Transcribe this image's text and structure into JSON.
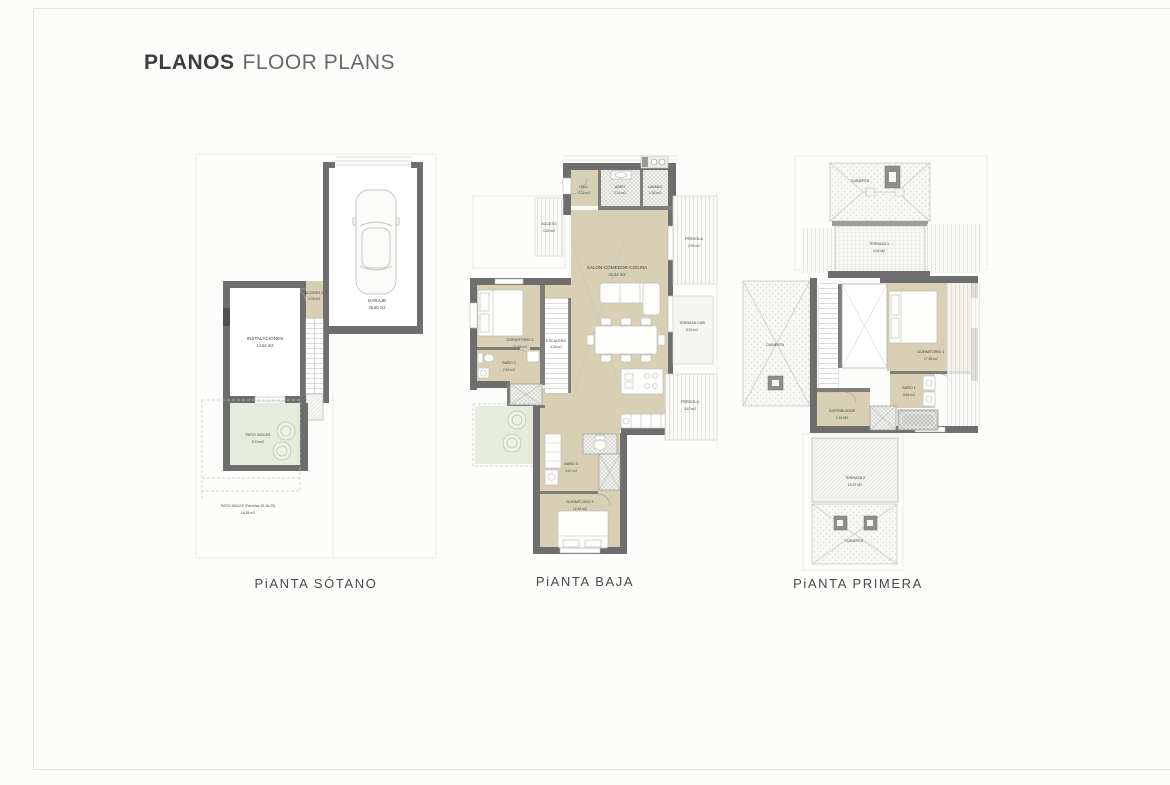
{
  "header": {
    "title_bold": "PLANOS",
    "title_light": "FLOOR PLANS"
  },
  "captions": {
    "sotano": "PiANTA SÓTANO",
    "baja": "PiANTA BAJA",
    "primera": "PiANTA PRIMERA"
  },
  "sotano": {
    "garaje": {
      "name": "GARAJE",
      "area": "26.50 m2"
    },
    "acceso2": {
      "name": "ACCESO 2",
      "area": "4.95 m2"
    },
    "instalaciones": {
      "name": "INSTALACIONES",
      "area": "14.64 m2"
    },
    "patio": {
      "name": "PATIO INGLES",
      "area": "8.10 m2"
    },
    "patio_parcelas": {
      "name": "PATIO INGLES (Parcelas 15-16-29)",
      "area": "16.38 m2"
    }
  },
  "baja": {
    "hall": {
      "name": "HALL",
      "area": "2.02 m2"
    },
    "aseo": {
      "name": "ASEO",
      "area": "2.24 m2"
    },
    "lavado": {
      "name": "LAVADO",
      "area": "1.92 m2"
    },
    "acceso": {
      "name": "ACCESO",
      "area": "3.20 m2"
    },
    "pergola1": {
      "name": "PÉRGOLA",
      "area": "2.90 m2"
    },
    "salon": {
      "name": "SALON-COMEDOR-COCINA",
      "area": "41.44 m2"
    },
    "escalera": {
      "name": "ESCALERA",
      "area": "4.38 m2"
    },
    "dormitorio2": {
      "name": "DORMITORIO 2",
      "area": "11.44 m2"
    },
    "bano2": {
      "name": "BAÑO 2",
      "area": "2.82 m2"
    },
    "terraza_cub": {
      "name": "TERRAZA CUB",
      "area": "5.61 m2"
    },
    "pergola2": {
      "name": "PÉRGOLA",
      "area": "3.52 m2"
    },
    "bano3": {
      "name": "BAÑO 3",
      "area": "3.57 m2"
    },
    "dormitorio3": {
      "name": "DORMITORIO 3",
      "area": "12.45 m2"
    }
  },
  "primera": {
    "cubierta_top": {
      "name": "CUBIERTA"
    },
    "terraza1": {
      "name": "TERRAZA 1",
      "area": "9.34 M2"
    },
    "cubierta_left": {
      "name": "CUBIERTA"
    },
    "dormitorio1": {
      "name": "DORMITORIO 1",
      "area": "17.55 m2"
    },
    "bano1": {
      "name": "BAÑO 1",
      "area": "3.64 m2"
    },
    "distribuidor": {
      "name": "DISTRIBUIDOR",
      "area": "1.91 M2"
    },
    "terraza2": {
      "name": "TERRAZA 2",
      "area": "10.37 M2"
    },
    "cubierta_bottom": {
      "name": "CUBIERTA"
    }
  },
  "colors": {
    "wall": "#6e6e6e",
    "room_fill": "#d8cfb4",
    "patio_green": "#e5ecdb",
    "text": "#4a4a4a"
  }
}
